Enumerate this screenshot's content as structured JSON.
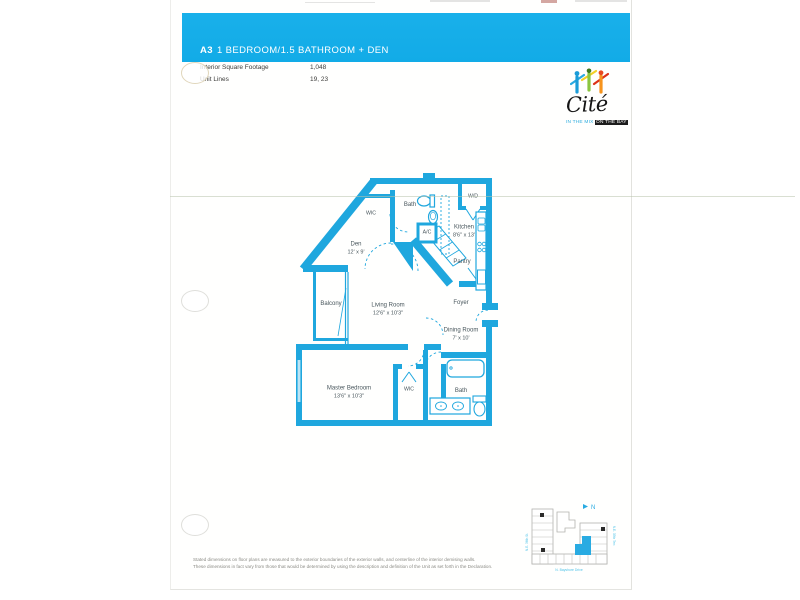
{
  "header": {
    "unit_code": "A3",
    "title": "1 BEDROOM/1.5 BATHROOM + DEN"
  },
  "info": {
    "rows": [
      {
        "label": "Interior Square Footage",
        "value": "1,048"
      },
      {
        "label": "Unit Lines",
        "value": "19, 23"
      }
    ]
  },
  "logo": {
    "name": "Cité",
    "tagline_left": "IN THE MIX",
    "tagline_right": "ON THE BAY"
  },
  "floor_plan": {
    "rooms": [
      {
        "name": "WIC",
        "dim": ""
      },
      {
        "name": "Bath",
        "dim": ""
      },
      {
        "name": "W/D",
        "dim": ""
      },
      {
        "name": "Kitchen",
        "dim": "8'6\" x 13'"
      },
      {
        "name": "A/C",
        "dim": ""
      },
      {
        "name": "Den",
        "dim": "12' x 9'"
      },
      {
        "name": "Pantry",
        "dim": ""
      },
      {
        "name": "Balcony",
        "dim": ""
      },
      {
        "name": "Living Room",
        "dim": "12'6\" x 10'3\""
      },
      {
        "name": "Foyer",
        "dim": ""
      },
      {
        "name": "Dining Room",
        "dim": "7' x 10'"
      },
      {
        "name": "Master Bedroom",
        "dim": "13'6\" x 10'3\""
      },
      {
        "name": "WIC",
        "dim": ""
      },
      {
        "name": "Bath",
        "dim": ""
      }
    ]
  },
  "disclaimer": {
    "line1": "Stated dimensions on floor plans are measured to the exterior boundaries of the exterior walls, and centerline of the interior demising walls.",
    "line2": "These dimensions in fact vary from those that would be determined by using the description and definition of the Unit as set forth in the Declaration."
  },
  "keyplan": {
    "north_label": "N",
    "street_bottom": "N. Bayshore Drive",
    "street_left": "N.E. 36th St.",
    "street_right": "N.E. 35th Terr."
  },
  "colors": {
    "accent_cyan": "#15ace8",
    "wall_cyan": "#1fa7de"
  }
}
